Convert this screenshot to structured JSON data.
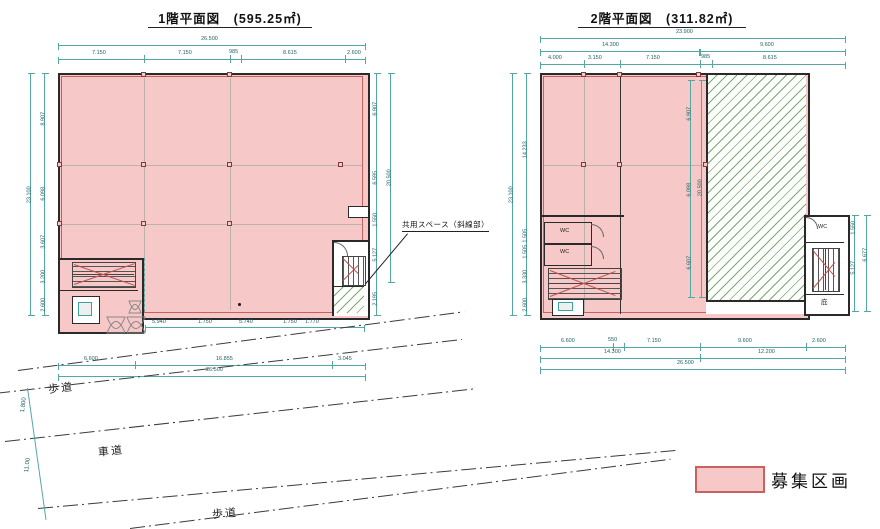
{
  "floor1": {
    "title": "1階平面図　(595.25㎡)",
    "dims": {
      "top_overall": "26.500",
      "top_segments": [
        "7.150",
        "7.150",
        "985",
        "8.615",
        "2.600"
      ],
      "left_overall": "23.100",
      "left_segments": [
        "8.907",
        "6.098",
        "3.607",
        "3.200",
        "2.600"
      ],
      "right_segments": [
        "6.907",
        "6.595",
        "1.550",
        "5.127",
        "2.195"
      ],
      "right_overall": "20.500",
      "bottom_inner": [
        "5.940",
        "1.750",
        "5.740",
        "1.750",
        "1.770"
      ],
      "bottom_row": [
        "6.600",
        "16.855",
        "3.045"
      ],
      "bottom_overall": "26.500"
    }
  },
  "floor2": {
    "title": "2階平面図　(311.82㎡)",
    "rooms": {
      "wc_left_1": "WC",
      "wc_left_2": "WC",
      "wc_tower": "WC",
      "canopy": "庇"
    },
    "dims": {
      "top_overall": "23.900",
      "top_row2": [
        "14.300",
        "9.600"
      ],
      "top_segments": [
        "4.000",
        "3.150",
        "7.150",
        "985",
        "8.615"
      ],
      "left_overall": "23.100",
      "left_segments": [
        "14.233",
        "1.505",
        "1.505",
        "3.330",
        "2.600"
      ],
      "interior_segments": [
        "6.907",
        "6.098",
        "6.607"
      ],
      "interior_overall": "20.500",
      "tower_segments": [
        "1.550",
        "5.127"
      ],
      "tower_overall": "6.677",
      "bottom_row1": [
        "6.600",
        "550",
        "7.150",
        "9.600",
        "2.600"
      ],
      "bottom_row2": [
        "14.300",
        "12.200"
      ],
      "bottom_overall": "26.500"
    }
  },
  "annotation": {
    "common_space": "共用スペース（斜線部）"
  },
  "legend": {
    "label": "募集区画",
    "fill": "#f7c8c8",
    "border": "#cc5f5f"
  },
  "roads": {
    "sidewalk_top": "歩道",
    "roadway": "車道",
    "sidewalk_bottom": "歩道",
    "width_dim": "11.00",
    "sidewalk_dim": "1.800"
  },
  "colors": {
    "parcel_fill": "#f7c8c8",
    "parcel_border": "#c4625f",
    "wall": "#2a2a2a",
    "dimension": "#54a8a2",
    "hatch": "#79a96b"
  }
}
